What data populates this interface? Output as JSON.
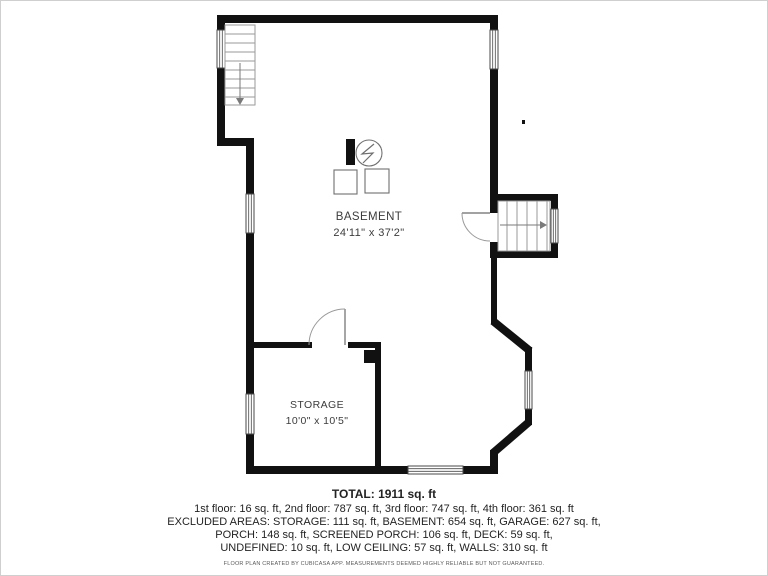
{
  "plan_title": "basement-floor-plan",
  "rooms": {
    "basement": {
      "label": "BASEMENT",
      "dims": "24'11\" x 37'2\""
    },
    "storage": {
      "label": "STORAGE",
      "dims": "10'0\" x 10'5\""
    }
  },
  "footer": {
    "total": "TOTAL: 1911 sq. ft",
    "floors": "1st floor: 16 sq. ft, 2nd floor: 787 sq. ft, 3rd floor: 747 sq. ft, 4th floor: 361 sq. ft",
    "excluded1": "EXCLUDED AREAS: STORAGE: 111 sq. ft, BASEMENT: 654 sq. ft, GARAGE: 627 sq. ft,",
    "excluded2": "PORCH: 148 sq. ft, SCREENED PORCH: 106 sq. ft, DECK: 59 sq. ft,",
    "excluded3": "UNDEFINED: 10 sq. ft, LOW CEILING: 57 sq. ft, WALLS: 310 sq. ft",
    "disclaimer": "FLOOR PLAN CREATED BY CUBICASA APP. MEASUREMENTS DEEMED HIGHLY RELIABLE BUT NOT GUARANTEED."
  },
  "colors": {
    "wall": "#111111",
    "thin_line": "#9a9a9a",
    "text": "#3c3c3c"
  }
}
